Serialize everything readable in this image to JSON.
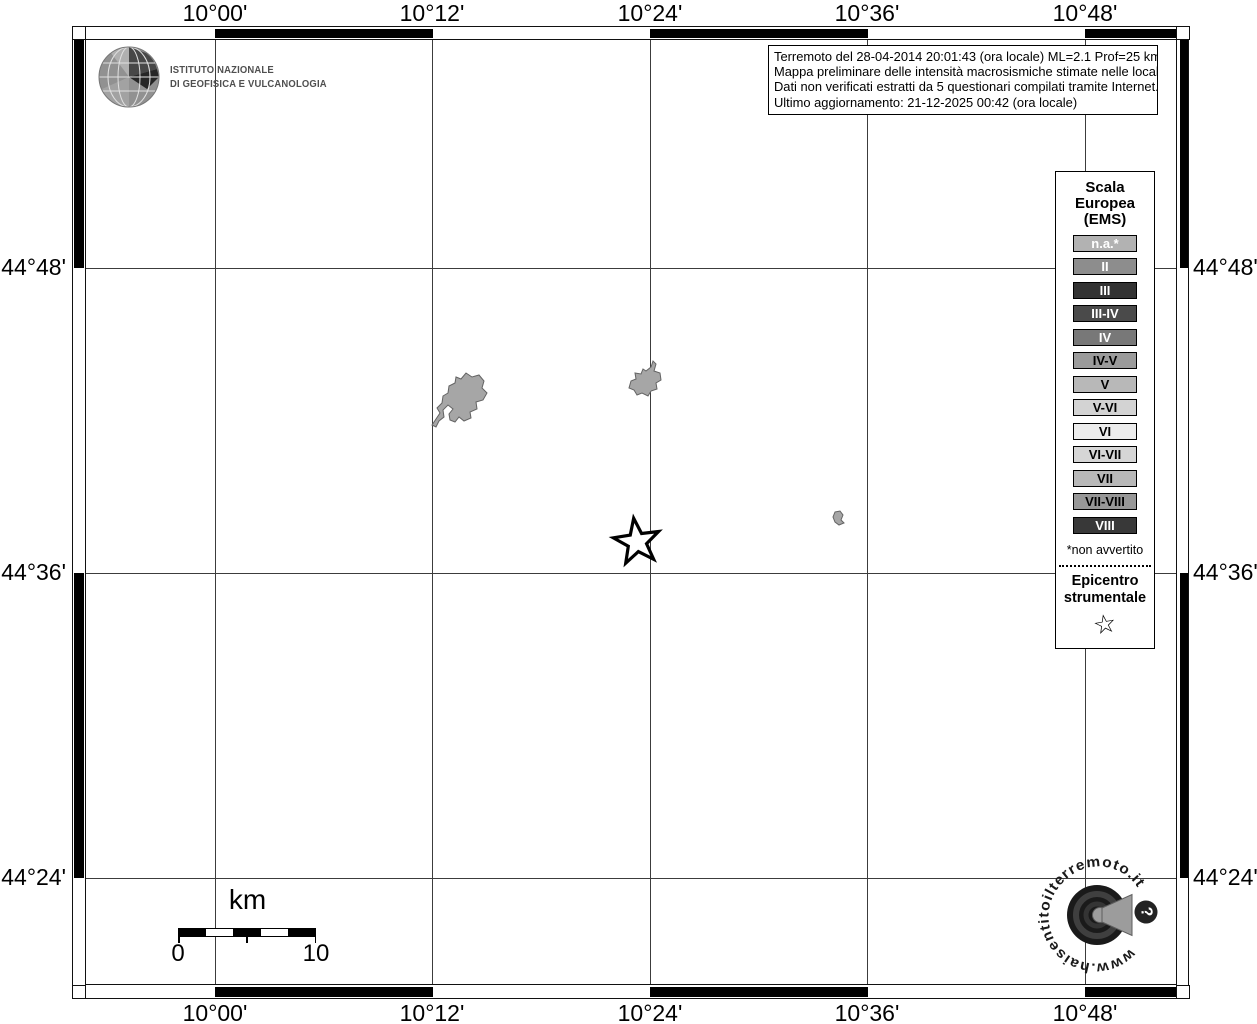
{
  "axes": {
    "lon": [
      "10°00'",
      "10°12'",
      "10°24'",
      "10°36'",
      "10°48'"
    ],
    "lat": [
      "44°48'",
      "44°36'",
      "44°24'"
    ]
  },
  "branding": {
    "ingv_line1": "ISTITUTO NAZIONALE",
    "ingv_line2": "DI GEOFISICA E VULCANOLOGIA"
  },
  "info_box": {
    "line1": "Terremoto del 28-04-2014 20:01:43 (ora locale) ML=2.1 Prof=25 km",
    "line2": "Mappa preliminare delle intensità macrosismiche stimate nelle località",
    "line3": "Dati non verificati estratti da 5 questionari compilati tramite Internet.",
    "line4": "Ultimo aggiornamento: 21-12-2025 00:42 (ora locale)"
  },
  "legend": {
    "title1": "Scala",
    "title2": "Europea",
    "title3": "(EMS)",
    "entries": [
      {
        "label": "n.a.*",
        "bg": "#b2b2b2",
        "fg": "#ffffff"
      },
      {
        "label": "II",
        "bg": "#8d8d8d",
        "fg": "#ffffff"
      },
      {
        "label": "III",
        "bg": "#333333",
        "fg": "#ffffff"
      },
      {
        "label": "III-IV",
        "bg": "#4a4a4a",
        "fg": "#ffffff"
      },
      {
        "label": "IV",
        "bg": "#787878",
        "fg": "#ffffff"
      },
      {
        "label": "IV-V",
        "bg": "#9b9b9b",
        "fg": "#000000"
      },
      {
        "label": "V",
        "bg": "#b8b8b8",
        "fg": "#000000"
      },
      {
        "label": "V-VI",
        "bg": "#d3d3d3",
        "fg": "#000000"
      },
      {
        "label": "VI",
        "bg": "#ececec",
        "fg": "#000000"
      },
      {
        "label": "VI-VII",
        "bg": "#d6d6d6",
        "fg": "#000000"
      },
      {
        "label": "VII",
        "bg": "#b8b8b8",
        "fg": "#000000"
      },
      {
        "label": "VII-VIII",
        "bg": "#979797",
        "fg": "#000000"
      },
      {
        "label": "VIII",
        "bg": "#383838",
        "fg": "#ffffff"
      }
    ],
    "footnote": "*non avvertito",
    "epicenter_title1": "Epicentro",
    "epicenter_title2": "strumentale",
    "epicenter_symbol": "☆"
  },
  "scale_bar": {
    "unit": "km",
    "start": "0",
    "end": "10"
  },
  "site_logo": {
    "circular_text": "www.haisentitoilterremoto.it",
    "badge": "?"
  }
}
